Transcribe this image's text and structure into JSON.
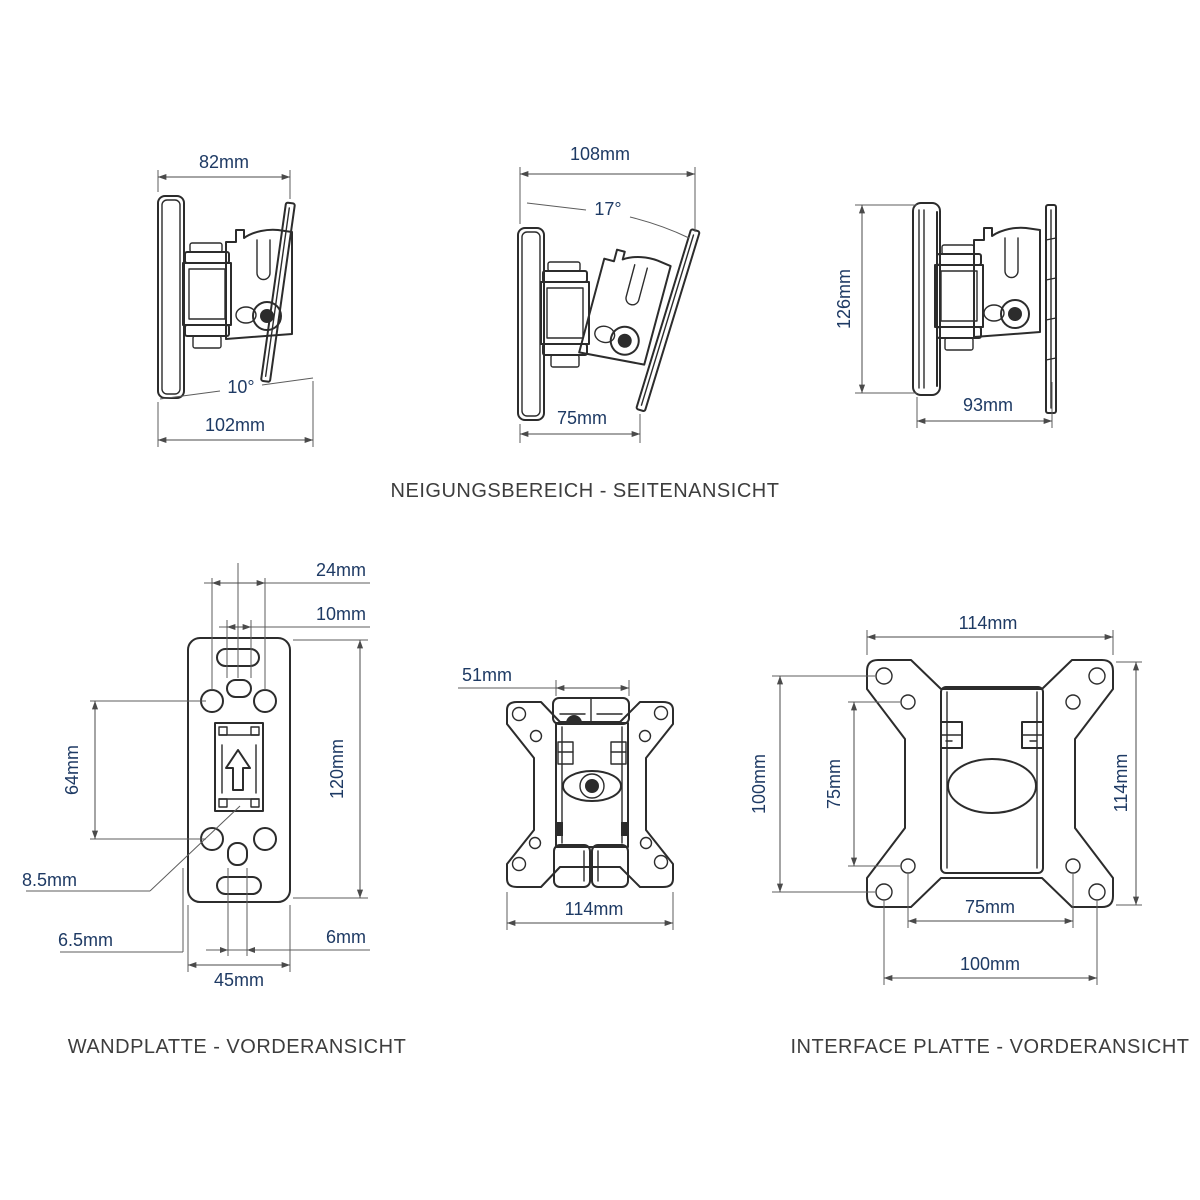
{
  "colors": {
    "background": "#ffffff",
    "drawing_line": "#2c2c2c",
    "dimension_line": "#5a5a5a",
    "dimension_text": "#1e3a64",
    "caption_text": "#3d3d3d"
  },
  "side_views": {
    "caption": "NEIGUNGSBEREICH - SEITENANSICHT",
    "tilt_down_view": {
      "top_width": "82mm",
      "angle": "10°",
      "bottom_width": "102mm"
    },
    "tilt_up_view": {
      "top_width": "108mm",
      "angle": "17°",
      "bottom_width": "75mm"
    },
    "neutral_view": {
      "height": "126mm",
      "depth": "93mm"
    }
  },
  "wall_plate_view": {
    "caption": "WANDPLATTE - VORDERANSICHT",
    "dims": {
      "top_hole_spacing": "24mm",
      "top_slot_width": "10mm",
      "vertical_hole_spacing": "64mm",
      "plate_height": "120mm",
      "slide_lock": "8.5mm",
      "hole_diameter": "6.5mm",
      "plate_width": "45mm",
      "bottom_slot_width": "6mm"
    }
  },
  "assembly_view": {
    "dims": {
      "bracket_width": "51mm",
      "plate_width": "114mm"
    }
  },
  "interface_plate_view": {
    "caption": "INTERFACE PLATTE - VORDERANSICHT",
    "dims": {
      "plate_width": "114mm",
      "outer_hole_spacing_vertical": "100mm",
      "inner_hole_spacing_vertical": "75mm",
      "plate_height": "114mm",
      "inner_hole_spacing_horizontal": "75mm",
      "outer_hole_spacing_horizontal": "100mm"
    }
  }
}
